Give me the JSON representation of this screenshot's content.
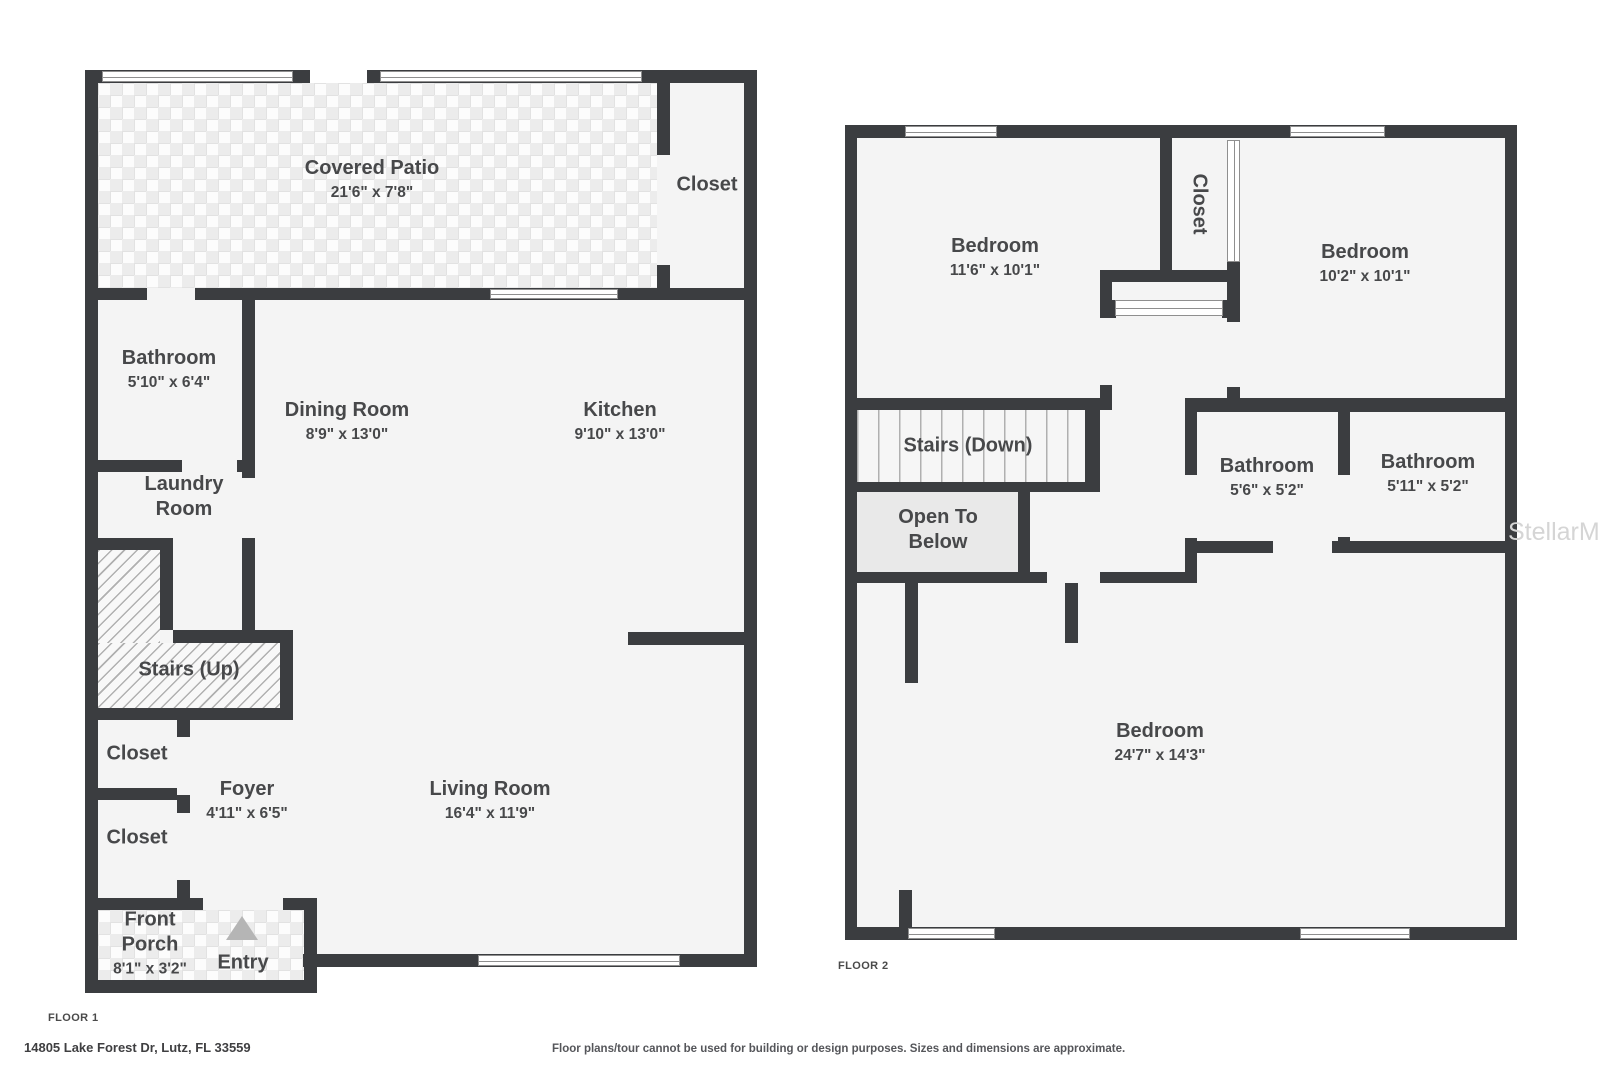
{
  "watermark": "StellarMLS",
  "footer": {
    "address": "14805 Lake Forest Dr, Lutz, FL 33559",
    "disclaimer": "Floor plans/tour cannot be used for building or design purposes. Sizes and dimensions are approximate."
  },
  "floor1": {
    "label": "FLOOR 1",
    "rooms": {
      "covered_patio": {
        "name": "Covered Patio",
        "dims": "21'6\" x 7'8\""
      },
      "closet_patio": {
        "name": "Closet"
      },
      "bathroom": {
        "name": "Bathroom",
        "dims": "5'10\" x 6'4\""
      },
      "dining_room": {
        "name": "Dining Room",
        "dims": "8'9\" x 13'0\""
      },
      "kitchen": {
        "name": "Kitchen",
        "dims": "9'10\" x 13'0\""
      },
      "laundry_room": {
        "name": "Laundry Room"
      },
      "stairs_up": {
        "name": "Stairs (Up)"
      },
      "closet_a": {
        "name": "Closet"
      },
      "closet_b": {
        "name": "Closet"
      },
      "foyer": {
        "name": "Foyer",
        "dims": "4'11\" x 6'5\""
      },
      "living_room": {
        "name": "Living Room",
        "dims": "16'4\" x 11'9\""
      },
      "front_porch": {
        "name": "Front Porch",
        "dims": "8'1\" x 3'2\""
      },
      "entry": {
        "name": "Entry"
      }
    }
  },
  "floor2": {
    "label": "FLOOR 2",
    "rooms": {
      "bedroom_left": {
        "name": "Bedroom",
        "dims": "11'6\" x 10'1\""
      },
      "closet": {
        "name": "Closet"
      },
      "bedroom_right": {
        "name": "Bedroom",
        "dims": "10'2\" x 10'1\""
      },
      "stairs_down": {
        "name": "Stairs (Down)"
      },
      "open_to_below": {
        "name": "Open To Below"
      },
      "bathroom_left": {
        "name": "Bathroom",
        "dims": "5'6\" x 5'2\""
      },
      "bathroom_right": {
        "name": "Bathroom",
        "dims": "5'11\" x 5'2\""
      },
      "bedroom_primary": {
        "name": "Bedroom",
        "dims": "24'7\" x 14'3\""
      }
    }
  },
  "colors": {
    "wall": "#3b3d40",
    "room_fill": "#f4f4f4",
    "open_to_below_fill": "#e9e9e9",
    "label_text": "#47484a",
    "entry_marker": "#b5b5b5",
    "watermark_gray": "#d5d5d5"
  }
}
